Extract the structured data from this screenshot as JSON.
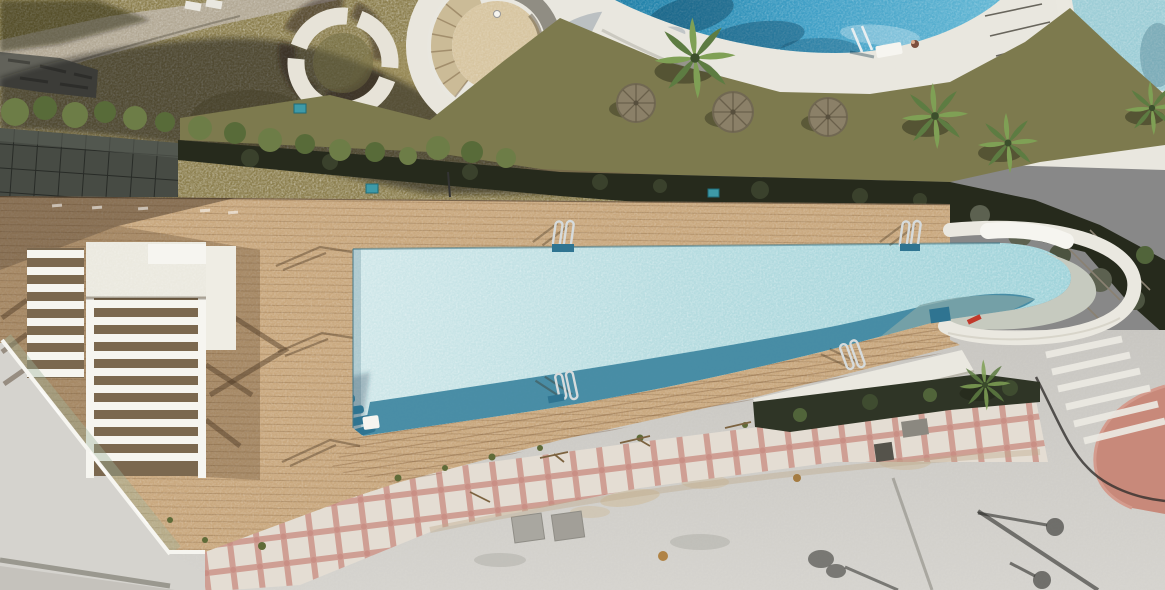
{
  "scene": {
    "description": "aerial-drone-photo-of-resort-pool-area",
    "canvas": {
      "width": 1165,
      "height": 590
    },
    "objects": [
      {
        "name": "main-infinity-pool",
        "shape": "long-wedge-with-curved-right-end",
        "approx": {
          "x1": 353,
          "y1": 243,
          "x2": 1135,
          "y2": 437
        },
        "features": [
          "corner-steps",
          "deep-edge-band",
          "curved-white-overflow-wall",
          "red-marker"
        ]
      },
      {
        "name": "upper-round-pool",
        "approx": {
          "cx": 810,
          "cy": 0,
          "visible_arc_bottom_y": 53
        },
        "features": [
          "white-rim",
          "ladder",
          "swimmer"
        ]
      },
      {
        "name": "corner-round-pool",
        "approx": {
          "x": 1072,
          "y": 0,
          "w": 93,
          "h": 95
        }
      },
      {
        "name": "wood-deck",
        "approx": {
          "x": 0,
          "y": 196,
          "w": 960,
          "h": 360
        },
        "features": [
          "plank-lines",
          "glass-balustrade",
          "shadow-top-left"
        ]
      },
      {
        "name": "pergola-slatted",
        "approx": {
          "x": 86,
          "y": 242,
          "w": 120,
          "h": 236
        }
      },
      {
        "name": "slatted-bench-steps",
        "approx": {
          "x": 27,
          "y": 248,
          "w": 57,
          "h": 130
        }
      },
      {
        "name": "circular-bench",
        "approx": {
          "cx": 343,
          "cy": 63,
          "r": 47,
          "segments": 4
        }
      },
      {
        "name": "spiral-stair-tower",
        "approx": {
          "cx": 497,
          "cy": 46,
          "outer_r": 70,
          "inner_r": 45
        }
      },
      {
        "name": "palm-trees",
        "count": 5
      },
      {
        "name": "wicker-parasols",
        "count": 3
      },
      {
        "name": "pool-ladders",
        "count": 5
      },
      {
        "name": "tiled-walkway",
        "pattern": "white-tiles-pink-grout"
      },
      {
        "name": "street",
        "features": [
          "lamp-post-shadows",
          "manhole-covers",
          "hatch-steps",
          "cable-line"
        ]
      },
      {
        "name": "pink-plaza",
        "approx": {
          "x": 1090,
          "y": 386,
          "w": 75,
          "h": 128
        }
      },
      {
        "name": "hedge-scrub-band",
        "approx": "diagonal dark band between garden and deck"
      }
    ]
  },
  "palette": {
    "water-light": "#cfe7e9",
    "water-mid": "#b6dce0",
    "water-edge": "#9fd3da",
    "water-deep": "#3e85a0",
    "water-deep2": "#2f7491",
    "water-fade": "#7fa5a8",
    "pool-upper": "#3f9fc6",
    "pool-upper-dark": "#1d7ea6",
    "pool-corner": "#9ccdd6",
    "sage": "#c6cabf",
    "white-conc": "#e9e7df",
    "bright-white": "#f6f5f0",
    "rim-shade": "#d8d5ca",
    "deck": "#c9a87e",
    "deck-light": "#d5b78f",
    "deck-shadow": "#8f7a5e",
    "deck-gap": "#7b684f",
    "lawn": "#8c7f4e",
    "lawn-light": "#a0925c",
    "gravel": "#b2a894",
    "hedge": "#262a1c",
    "scrub": "#3a412c",
    "bush": "#6d7d47",
    "bush-dark": "#51643a",
    "palm": "#7fa055",
    "palm-dark": "#5d7c42",
    "rock": "#5c6150",
    "tile-base": "#e4ddd3",
    "grout": "#cf9f94",
    "street": "#c8c6c1",
    "street-light": "#d5d3ce",
    "street-dark": "#bdbbb5",
    "pink-plaza": "#c8897a",
    "glass": "#a9bba6",
    "stone": "#62625a",
    "dark-pave": "#474b44",
    "teal-sign": "#3e9aa8",
    "umbrella": "#8b8068",
    "umbrella-line": "#6a604b",
    "chrome": "#d6dbdc",
    "red-marker": "#c0392b",
    "tower-tan": "#d7c5a0",
    "tower-step": "#cbbb97",
    "shadow": "#2a261c",
    "wall-white": "#eae8e0",
    "dirt": "#75634a",
    "twig": "#7c6340"
  }
}
